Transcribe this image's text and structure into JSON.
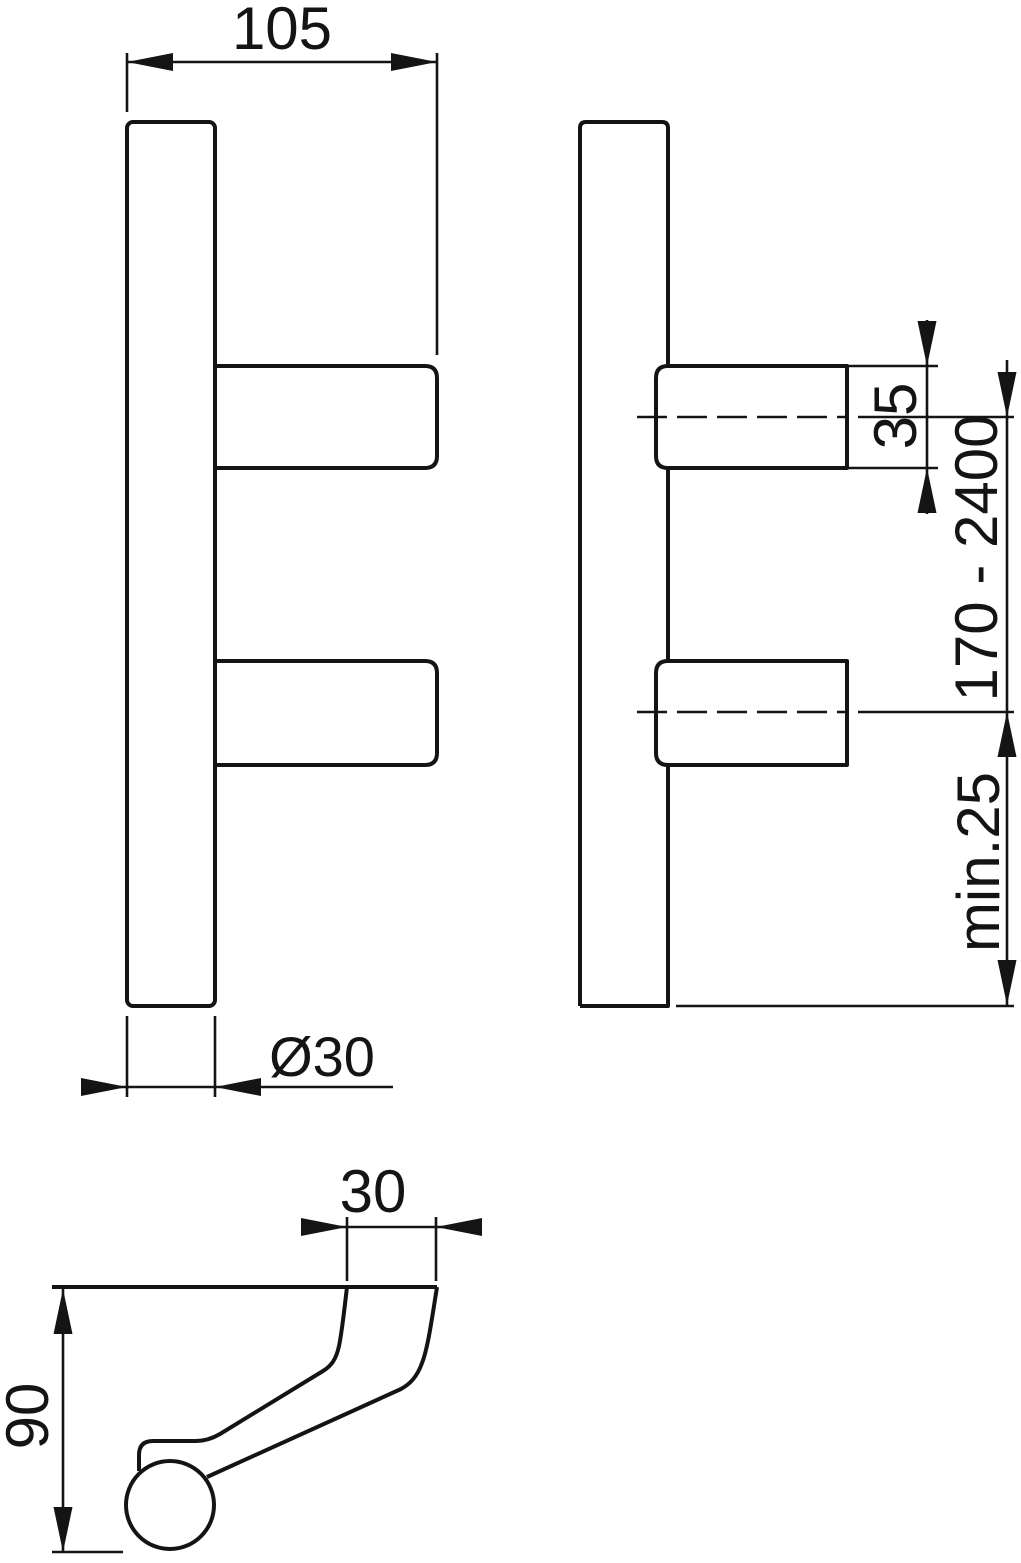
{
  "drawing": {
    "background": "#ffffff",
    "line_color": "#141414",
    "labels": {
      "overall_depth": "105",
      "tube_diameter": "Ø30",
      "fixing_height": "35",
      "fixing_centres_range": "170 - 2400",
      "min_edge_distance": "min.25",
      "neck_width": "30",
      "projection": "90"
    }
  }
}
